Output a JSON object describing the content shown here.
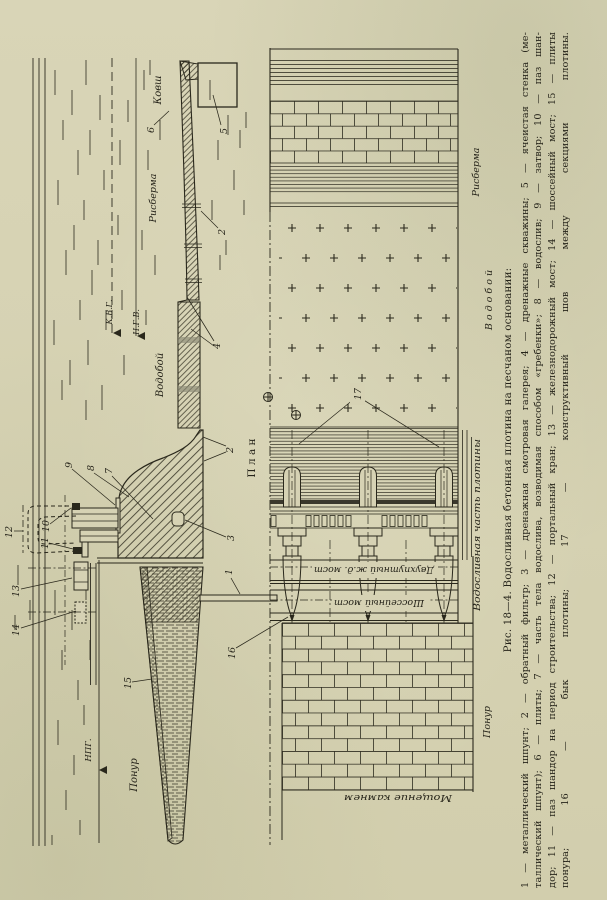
{
  "page": {
    "bg": "#d6d2b4",
    "ink": "#2a281c"
  },
  "figure": {
    "caption": {
      "title": "Рис. 18—4. Водосливная бетонная плотина на песчаном основании:",
      "legend_lines": [
        "1 — металлический шпунт; 2 — обратный фильтр; 3 — дренажная смотровая галерея; 4 — дренажные скважины; 5 — ячеистая стенка (ме-",
        "таллический шпунт); 6 — плиты; 7 — часть тела водослива, возводимая способом «гребенки»; 8 — водослив; 9 — затвор; 10 — паз шан-",
        "дор; 11 — паз шандор на период строительства; 12 — портальный кран; 13 — железнодорожный мост; 14 — шоссейный мост; 15 — плиты",
        "понура; 16 — бык плотины; 17 — конструктивный шов между секциями плотины."
      ]
    },
    "section_labels": {
      "kovsh": "Ковш",
      "risberma": "Рисберма",
      "vodoboi": "Водобой",
      "kvg": "К.В.Г.",
      "ngv": "Н.Г.В.",
      "npg": "НПГ.",
      "plan": "П л а н",
      "ponur": "Понур"
    },
    "plan_labels": {
      "risberma": "Рисберма",
      "vodoboi": "В о д о б о й",
      "spillway_part": "Водосливная часть плотины",
      "ponur": "Понур",
      "rail_bridge": "Двухпутный ж.д. мост",
      "road_bridge": "Шоссейный мост",
      "paving": "Мощение камнем"
    },
    "callouts": {
      "n1": "1",
      "n2": "2",
      "n3": "3",
      "n4": "4",
      "n5": "5",
      "n6": "6",
      "n7": "7",
      "n8": "8",
      "n9": "9",
      "n10": "10",
      "n11": "11",
      "n12": "12",
      "n13": "13",
      "n14": "14",
      "n15": "15",
      "n16": "16",
      "n17": "17"
    }
  }
}
